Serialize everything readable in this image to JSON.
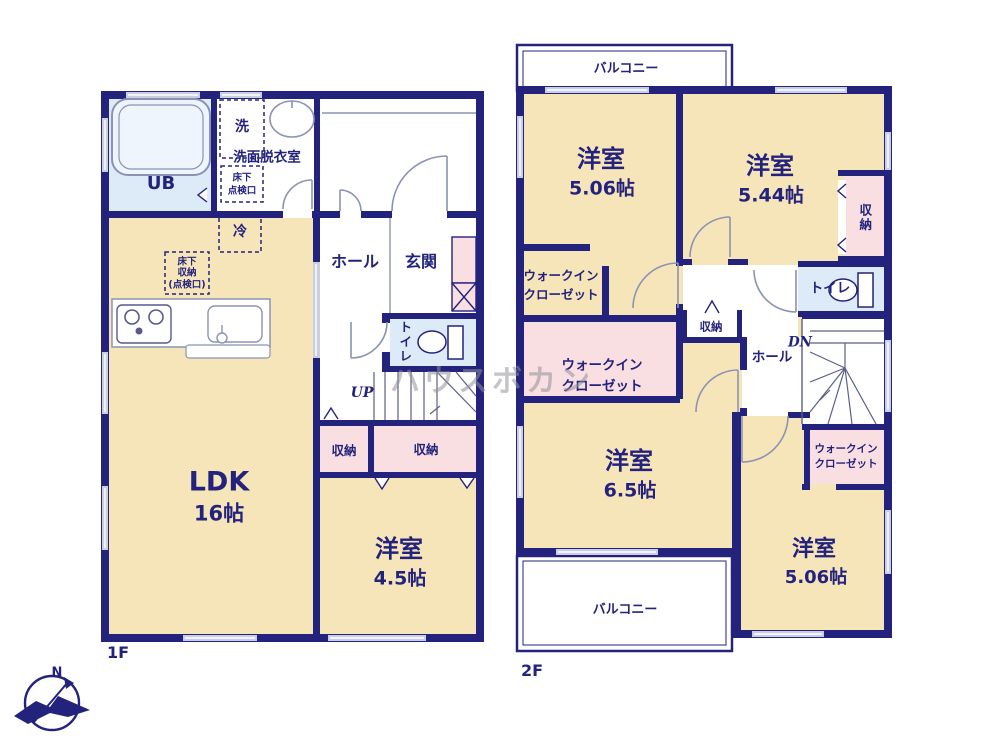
{
  "watermark": "ハウスボカン",
  "compass": {
    "north": "N"
  },
  "colors": {
    "wall": "#23237d",
    "room_cream": "#f7e5ba",
    "closet_pink": "#f9dee2",
    "wet_blue": "#dcebf7",
    "window_gray": "#c9cfe0",
    "door_gray": "#8b93b5"
  },
  "f1": {
    "floor": "1F",
    "ub": "UB",
    "washer": "洗",
    "senmen": "洗面脱衣室",
    "tenken1": "床下",
    "tenken2": "点検口",
    "rei": "冷",
    "yshuno1": "床下",
    "yshuno2": "収納",
    "yshuno3": "(点検口)",
    "hall": "ホール",
    "genkan": "玄関",
    "toilet": "トイレ",
    "up": "UP",
    "st_a": "収納",
    "st_b": "収納",
    "ldk": "LDK",
    "ldk_size": "16帖",
    "r1": "洋室",
    "r1_size": "4.5帖"
  },
  "f2": {
    "floor": "2F",
    "balcony_n": "バルコニー",
    "balcony_s": "バルコニー",
    "nw": "洋室",
    "nw_size": "5.06帖",
    "ne": "洋室",
    "ne_size": "5.44帖",
    "ne_closet": "収納",
    "wic1a": "ウォークイン",
    "wic1b": "クローゼット",
    "wic2a": "ウォークイン",
    "wic2b": "クローゼット",
    "wic3a": "ウォークイン",
    "wic3b": "クローゼット",
    "st_c": "収納",
    "toilet": "トイレ",
    "dn": "DN",
    "hall": "ホール",
    "c": "洋室",
    "c_size": "6.5帖",
    "se": "洋室",
    "se_size": "5.06帖"
  }
}
